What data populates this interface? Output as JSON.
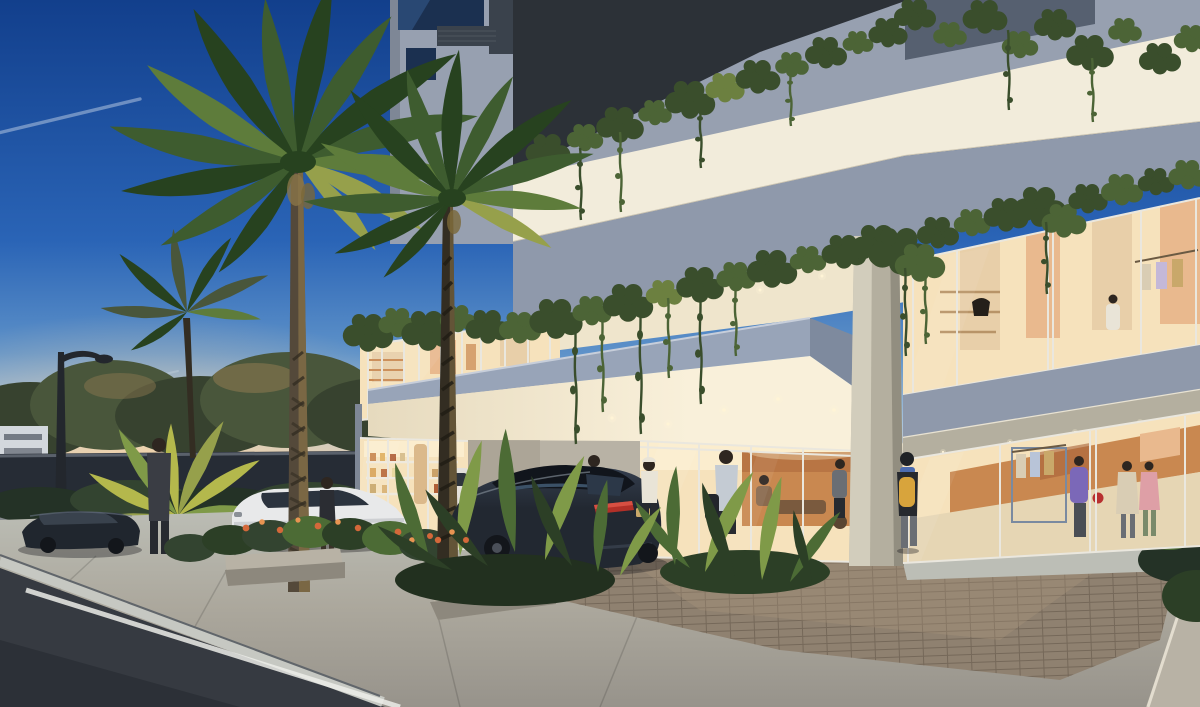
{
  "image": {
    "width": 1200,
    "height": 707
  },
  "scene": {
    "setting": "dusk architectural rendering of a modern mixed-use building entrance drive",
    "elements": {
      "sky": "dusk sky with jet contrails",
      "building": "concrete building with planted balcony edges and lit soffits",
      "canopy": "blue-gray entrance canopy volume",
      "pillar": "corner column at the drop-off",
      "lobby": "glazed lobby with warm lighting and seated guests",
      "cafe": "corner cafe with lit shelving",
      "boutique": "ground-floor clothing boutique with shoppers",
      "upper-showroom": "second-floor retail showroom with mannequins",
      "palms": "royal palms at the drop-off",
      "planter": "fern and flower planter box",
      "cars": "sedans at the entrance drive and street",
      "pedestrians": "people walking at dusk",
      "street": "asphalt street with painted curb line",
      "pavers": "brick paver drop-off apron",
      "street-lamp": "street lamp silhouette"
    }
  },
  "palette": {
    "sky_top": "#123F8C",
    "sky_mid": "#2A64B6",
    "sky_light": "#5E92C9",
    "sky_pale": "#A9C4DC",
    "sky_horizon": "#E8C9A2",
    "sunset": "#F2B77E",
    "glow": "#FFD9A6",
    "contrail": "#E8F0F8",
    "tree_dark": "#37422F",
    "tree_mid": "#49563B",
    "tree_warm": "#907B52",
    "far_bldg": "#D3D8DD",
    "wall_dark": "#262C35",
    "wall_cap": "#5A616B",
    "far_walk": "#84878B",
    "shrub_dark": "#243226",
    "shrub_mid": "#334430",
    "plaza_light": "#BCBEB6",
    "plaza_mid": "#ACA89D",
    "plaza_dark": "#97938B",
    "paver": "#8F8170",
    "paver_warm": "#A8947C",
    "asphalt": "#363A41",
    "asphalt_dark": "#2C3037",
    "curb": "#C6C8C2",
    "stripe": "#ECEDE9",
    "planter_wall": "#B8B2A5",
    "planter_shade": "#8D887D",
    "conc": "#97A0B0",
    "conc_dark": "#7E8796",
    "conc_edge": "#B9C0CC",
    "soffit_dark": "#2C3137",
    "upper_dark": "#566070",
    "band_lit": "#F2ECDB",
    "band_shade": "#8F99AB",
    "box_face": "#98A4B8",
    "box_side": "#7E8A9E",
    "box_hi": "#C7CEDA",
    "ceil_warm": "#EFE5CC",
    "ceil_bright": "#F9F0DA",
    "downlight": "#FFF4D6",
    "pillar_hi": "#DAD4C3",
    "pillar_mid": "#B4AF9F",
    "pillar_sh": "#928E80",
    "glass_dark": "#1B3050",
    "glass_mid": "#2D4F7C",
    "grille": "#3A424C",
    "frame": "#EAE7DE",
    "int_warm": "#F6E2BC",
    "int_bright": "#FBEDCE",
    "wood": "#C98850",
    "wood_dark": "#A86238",
    "panel": "#E8CFA9",
    "peach": "#E9B98E",
    "vine_dark": "#3A4E2C",
    "vine_mid": "#4C6436",
    "vine_lit": "#6C8040",
    "palm_dark": "#27421F",
    "palm_mid": "#3E5C2F",
    "palm_light": "#5E7C3B",
    "palm_lit": "#96A04B",
    "trunk_dark": "#332D22",
    "trunk_mid": "#54493A",
    "trunk_hi": "#8A7549",
    "cycad": "#B4B84C",
    "fern_dark": "#2C3F26",
    "fern_mid": "#4C6B35",
    "fern_lit": "#7F9A48",
    "flower": "#D4683A",
    "flower_lt": "#E89452",
    "car1": "#1C2430",
    "car1_hi": "#3C4A5C",
    "car_glass": "#33404F",
    "tail": "#B23028",
    "plate": "#C9A86A",
    "car_white": "#E8E9EA",
    "car_white_sh": "#C2C5C9",
    "wheel": "#13161B",
    "suit": "#3A3D44",
    "head": "#2E2620",
    "shirt": "#E9E4D7",
    "shirt_blue": "#C4CBD3",
    "pants": "#272A30",
    "legs": "#6A6E74",
    "bag": "#22252B",
    "backpack": "#D8A43C",
    "scarf": "#4C6CB0",
    "shop_purple": "#7B68B8",
    "shop_beige": "#D9CDB4",
    "shop_pink": "#DE9FA6",
    "bag_red": "#B83030",
    "lamp": "#23272D",
    "shadow": "rgba(18,16,22,0.35)"
  }
}
